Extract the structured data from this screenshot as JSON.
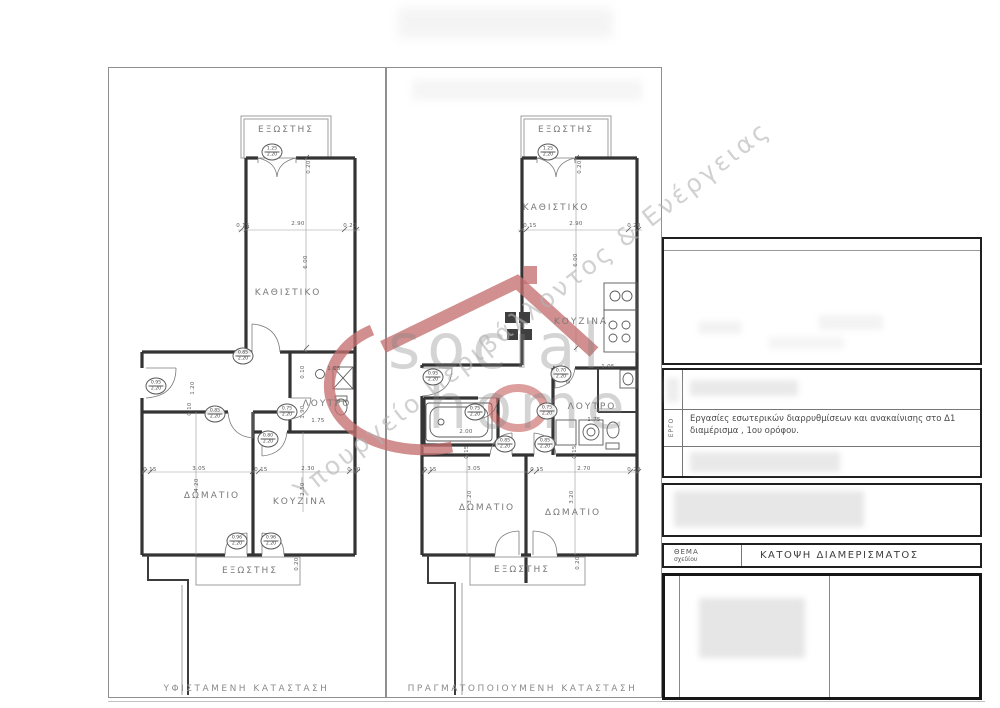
{
  "watermark": {
    "brand_line1": "social",
    "brand_line2": "home",
    "diagonal_text": "Υπουργείο Περιβάλλοντος & Ενέργειας",
    "accent_red": "#c4706f"
  },
  "plans": {
    "left": {
      "caption": "ΥΦΙΣΤΑΜΕΝΗ ΚΑΤΑΣΤΑΣΗ",
      "rooms": [
        {
          "text": "ΕΞΩΣΤΗΣ",
          "x": 286,
          "y": 130
        },
        {
          "text": "ΚΑΘΙΣΤΙΚΟ",
          "x": 288,
          "y": 293
        },
        {
          "text": "ΛΟΥΤΡΟ",
          "x": 327,
          "y": 404
        },
        {
          "text": "ΔΩΜΑΤΙΟ",
          "x": 212,
          "y": 496
        },
        {
          "text": "ΚΟΥΖΙΝΑ",
          "x": 300,
          "y": 502
        },
        {
          "text": "ΕΞΩΣΤΗΣ",
          "x": 250,
          "y": 571
        }
      ],
      "dims": [
        {
          "v": "0.15",
          "x": 243,
          "y": 226,
          "rot": 0
        },
        {
          "v": "2.90",
          "x": 298,
          "y": 224,
          "rot": 0
        },
        {
          "v": "0.20",
          "x": 350,
          "y": 226,
          "rot": 0
        },
        {
          "v": "0.20",
          "x": 309,
          "y": 167,
          "rot": 1
        },
        {
          "v": "6.00",
          "x": 306,
          "y": 262,
          "rot": 1
        },
        {
          "v": "1.20",
          "x": 193,
          "y": 388,
          "rot": 1
        },
        {
          "v": "0.10",
          "x": 190,
          "y": 409,
          "rot": 1
        },
        {
          "v": "0.10",
          "x": 303,
          "y": 372,
          "rot": 1
        },
        {
          "v": "1.90",
          "x": 303,
          "y": 412,
          "rot": 1
        },
        {
          "v": "1.05",
          "x": 334,
          "y": 369,
          "rot": 0
        },
        {
          "v": "1.75",
          "x": 318,
          "y": 421,
          "rot": 0
        },
        {
          "v": "0.15",
          "x": 150,
          "y": 470,
          "rot": 0
        },
        {
          "v": "3.05",
          "x": 199,
          "y": 469,
          "rot": 0
        },
        {
          "v": "0.15",
          "x": 261,
          "y": 470,
          "rot": 0
        },
        {
          "v": "2.30",
          "x": 308,
          "y": 469,
          "rot": 0
        },
        {
          "v": "0.20",
          "x": 354,
          "y": 470,
          "rot": 0
        },
        {
          "v": "4.20",
          "x": 197,
          "y": 485,
          "rot": 1
        },
        {
          "v": "2.50",
          "x": 303,
          "y": 489,
          "rot": 1
        },
        {
          "v": "0.20",
          "x": 297,
          "y": 564,
          "rot": 1
        }
      ],
      "doors": [
        {
          "w": "1.25",
          "h": "2.20",
          "x": 272,
          "y": 152
        },
        {
          "w": "0.85",
          "h": "2.20",
          "x": 243,
          "y": 356
        },
        {
          "w": "0.95",
          "h": "2.20",
          "x": 156,
          "y": 386
        },
        {
          "w": "0.85",
          "h": "2.20",
          "x": 215,
          "y": 414
        },
        {
          "w": "0.75",
          "h": "2.20",
          "x": 287,
          "y": 412
        },
        {
          "w": "0.80",
          "h": "2.20",
          "x": 268,
          "y": 439
        },
        {
          "w": "0.96",
          "h": "2.20",
          "x": 237,
          "y": 541
        },
        {
          "w": "0.96",
          "h": "2.20",
          "x": 271,
          "y": 541
        }
      ]
    },
    "right": {
      "caption": "ΠΡΑΓΜΑΤΟΠΟΙΟΥΜΕΝΗ ΚΑΤΑΣΤΑΣΗ",
      "rooms": [
        {
          "text": "ΕΞΩΣΤΗΣ",
          "x": 566,
          "y": 130
        },
        {
          "text": "ΚΑΘΙΣΤΙΚΟ",
          "x": 556,
          "y": 208
        },
        {
          "text": "ΚΟΥΖΙΝΑ",
          "x": 581,
          "y": 322
        },
        {
          "text": "ΛΟΥΤΡΟ",
          "x": 592,
          "y": 407
        },
        {
          "text": "ΔΩΜΑΤΙΟ",
          "x": 487,
          "y": 508
        },
        {
          "text": "ΔΩΜΑΤΙΟ",
          "x": 573,
          "y": 513
        },
        {
          "text": "ΕΞΩΣΤΗΣ",
          "x": 522,
          "y": 570
        }
      ],
      "dims": [
        {
          "v": "0.15",
          "x": 530,
          "y": 226,
          "rot": 0
        },
        {
          "v": "2.90",
          "x": 576,
          "y": 224,
          "rot": 0
        },
        {
          "v": "0.20",
          "x": 634,
          "y": 226,
          "rot": 0
        },
        {
          "v": "0.20",
          "x": 580,
          "y": 167,
          "rot": 1
        },
        {
          "v": "6.00",
          "x": 576,
          "y": 260,
          "rot": 1
        },
        {
          "v": "1.05",
          "x": 608,
          "y": 367,
          "rot": 0
        },
        {
          "v": "0.7",
          "x": 569,
          "y": 379,
          "rot": 1
        },
        {
          "v": "1.75",
          "x": 594,
          "y": 420,
          "rot": 0
        },
        {
          "v": "2.00",
          "x": 466,
          "y": 432,
          "rot": 0
        },
        {
          "v": "0.15",
          "x": 430,
          "y": 470,
          "rot": 0
        },
        {
          "v": "3.05",
          "x": 474,
          "y": 469,
          "rot": 0
        },
        {
          "v": "0.15",
          "x": 537,
          "y": 470,
          "rot": 0
        },
        {
          "v": "2.70",
          "x": 584,
          "y": 469,
          "rot": 0
        },
        {
          "v": "0.20",
          "x": 634,
          "y": 470,
          "rot": 0
        },
        {
          "v": "0.15",
          "x": 467,
          "y": 452,
          "rot": 1
        },
        {
          "v": "0.15",
          "x": 575,
          "y": 452,
          "rot": 1
        },
        {
          "v": "3.20",
          "x": 470,
          "y": 497,
          "rot": 1
        },
        {
          "v": "3.20",
          "x": 572,
          "y": 497,
          "rot": 1
        },
        {
          "v": "0.20",
          "x": 578,
          "y": 563,
          "rot": 1
        }
      ],
      "doors": [
        {
          "w": "1.25",
          "h": "2.20",
          "x": 548,
          "y": 152
        },
        {
          "w": "0.95",
          "h": "2.20",
          "x": 433,
          "y": 377
        },
        {
          "w": "0.75",
          "h": "2.20",
          "x": 475,
          "y": 412
        },
        {
          "w": "0.70",
          "h": "2.20",
          "x": 561,
          "y": 374
        },
        {
          "w": "0.75",
          "h": "2.20",
          "x": 547,
          "y": 411
        },
        {
          "w": "0.85",
          "h": "2.20",
          "x": 505,
          "y": 444
        },
        {
          "w": "0.85",
          "h": "2.20",
          "x": 545,
          "y": 444
        }
      ]
    }
  },
  "title_block": {
    "project_label": "ΕΡΓΟ",
    "project_text": "Εργασίες εσωτερικών διαρρυθμίσεων και ανακαίνισης στο Δ1 διαμέρισμα , 1ου ορόφου.",
    "subject_label_line1": "ΘΕΜΑ",
    "subject_label_line2": "σχεδίου",
    "subject_value": "ΚΑΤΟΨΗ ΔΙΑΜΕΡΙΣΜΑΤΟΣ"
  }
}
